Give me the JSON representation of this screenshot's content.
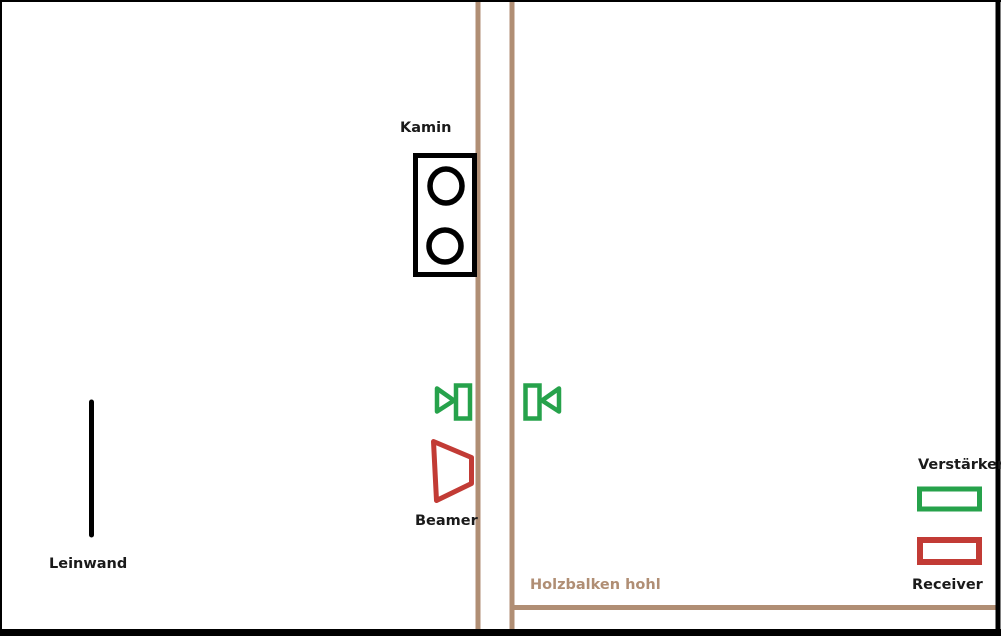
{
  "diagram": {
    "type": "room-layout-sketch",
    "labels": {
      "kamin": "Kamin",
      "leinwand": "Leinwand",
      "beamer": "Beamer",
      "holzbalken": "Holzbalken hohl"
    },
    "legend": {
      "verstaerker": "Verstärker",
      "receiver": "Receiver"
    },
    "colors": {
      "wood": "#B08E74",
      "green": "#26A24B",
      "red": "#C23B35",
      "ink": "#000000",
      "label_text": "#1A1A1A",
      "background": "#FFFFFF"
    },
    "icons": {
      "fireplace": "rectangle-with-two-circles",
      "screen": "vertical-line",
      "speaker_left": "speaker-outline-facing-right",
      "speaker_right": "speaker-outline-facing-left",
      "projector": "trapezoid-outline"
    }
  }
}
